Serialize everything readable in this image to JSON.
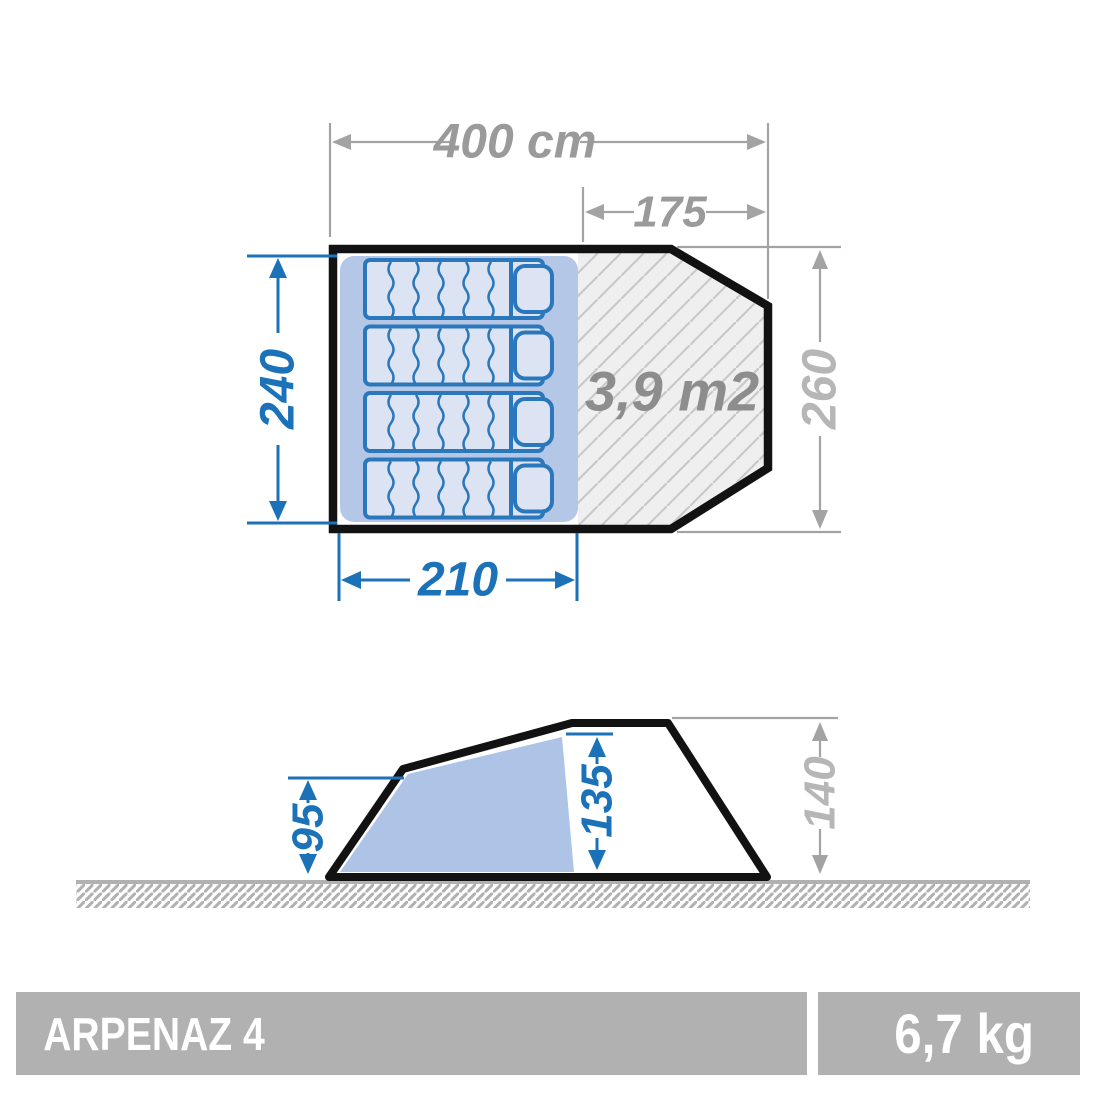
{
  "top_view": {
    "total_width": "400 cm",
    "porch_depth": "175",
    "bedroom_width": "240",
    "total_depth": "260",
    "bedroom_length": "210",
    "living_area": "3,9 m2"
  },
  "side_view": {
    "entrance_height": "95",
    "bedroom_height": "135",
    "peak_height": "140"
  },
  "footer": {
    "model": "ARPENAZ 4",
    "weight": "6,7 kg"
  },
  "colors": {
    "dimension_blue": "#1b72b8",
    "dimension_gray": "#9a9a9a",
    "light_gray_text": "#b6b6b6",
    "area_text_gray": "#8d8d8d",
    "outline_black": "#121212",
    "bedroom_fill": "#b5c7e6",
    "side_bedroom_fill": "#adc4e6",
    "mattress_fill": "#dce4f3",
    "mattress_stroke": "#2a77bb",
    "living_hatch_bg": "#efefef",
    "living_hatch_line": "#c9c9c9",
    "ground_gray": "#b1b1b1",
    "bar_gray": "#b1b1b1",
    "bar_text_white": "#ffffff"
  }
}
